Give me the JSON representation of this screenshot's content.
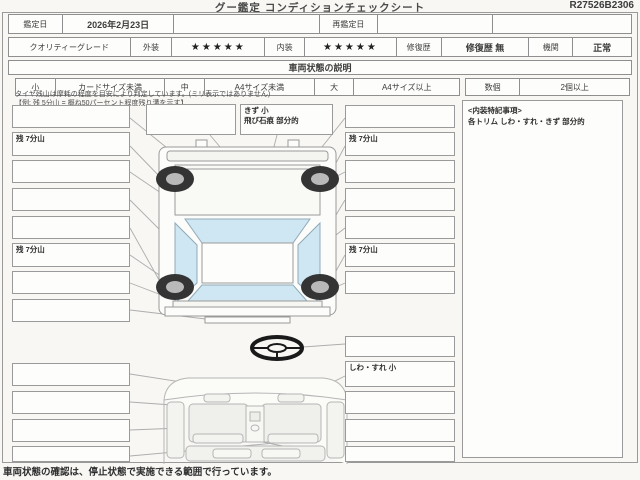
{
  "sheet": {
    "title": "グー鑑定 コンディションチェックシート",
    "ref_no": "R27526B2306",
    "appraisal": {
      "date_label": "鑑定日",
      "date_value": "2026年2月23日",
      "redate_label": "再鑑定日",
      "redate_value": ""
    },
    "grade": {
      "label": "クオリティーグレード",
      "exterior_label": "外装",
      "exterior_stars": "★★★★★",
      "interior_label": "内装",
      "interior_stars": "★★★★★",
      "repair_label": "修復歴",
      "repair_value": "修復歴 無",
      "engine_label": "機関",
      "engine_value": "正常"
    },
    "section_title": "車両状態の説明",
    "size_legend": [
      {
        "label": "小",
        "desc": "カードサイズ未満"
      },
      {
        "label": "中",
        "desc": "A4サイズ未満"
      },
      {
        "label": "大",
        "desc": "A4サイズ以上"
      }
    ],
    "count_legend": {
      "label": "数個",
      "desc": "2個以上"
    },
    "tire_note_line1": "タイヤ残山は摩耗の程度を目安により判定しています。(ミリ表示ではありません)",
    "tire_note_line2": "【例: 残 5分山 = 概ね50パーセント程度残り溝を示す】",
    "exterior": {
      "top_boxes": [
        "",
        "きず 小\n飛び石痕 部分的"
      ],
      "left_boxes": [
        "",
        "残 7分山",
        "",
        "",
        "",
        "残 7分山",
        "",
        ""
      ],
      "right_boxes": [
        "",
        "残 7分山",
        "",
        "",
        "",
        "残 7分山",
        ""
      ]
    },
    "interior": {
      "left_boxes": [
        "",
        "",
        "",
        ""
      ],
      "right_boxes": [
        "",
        "しわ・すれ 小",
        "",
        "",
        ""
      ],
      "notes_title": "<内装特記事項>",
      "notes_body": "各トリム しわ・すれ・きず 部分的"
    },
    "footer_note": "車両状態の確認は、停止状態で実施できる範囲で行っています。"
  }
}
